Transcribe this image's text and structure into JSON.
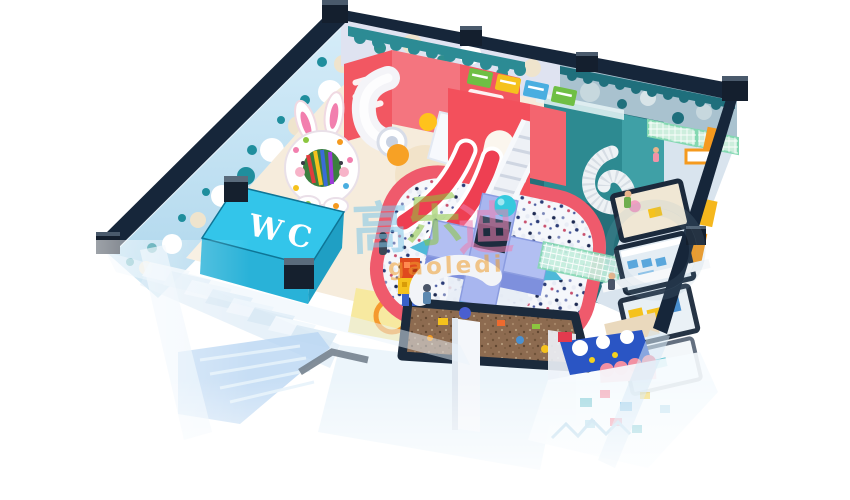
{
  "scene": {
    "description": "isometric 3D render of an indoor children playground",
    "background_color": "#ffffff",
    "wc_sign": {
      "label": "WC",
      "box_color": "#2fc0e4",
      "text_color": "#ffffff"
    },
    "watermark": {
      "chars": [
        {
          "text": "高",
          "color": "#7fc6e8"
        },
        {
          "text": "乐",
          "color": "#8cc63f"
        },
        {
          "text": "迪",
          "color": "#ef7fb0"
        }
      ],
      "latin": "gaoledi",
      "latin_color": "#f09e2e"
    },
    "palette": {
      "wall_frame_navy": "#16263a",
      "left_wall_blue": "#cfe9f7",
      "back_wall_lavender": "#dfe3f1",
      "teal_wall": "#2e8b92",
      "pink_structure": "#f4616d",
      "red_slide": "#ee4157",
      "ball_pit": "#f5f7fb",
      "platform_blue": "#aebdf2",
      "sand_brown": "#8d6b50",
      "glass_frame": "#1b2a3c",
      "orange_accent": "#f59a1e",
      "mesh_green": "#bfe9d6",
      "cyan_accent": "#36c9de",
      "fade_foreground": "#eaf4fb"
    },
    "elements": [
      "polka-dot-walls",
      "toddler-soft-play",
      "bunny-donut-decor",
      "tube-slide",
      "double-wave-slide",
      "white-staircase",
      "ring-ball-pit",
      "center-platform",
      "mesh-bridge",
      "spiral-slide",
      "climbing-nets",
      "party-rooms",
      "sand-pit",
      "wc-room",
      "entrance-stairs",
      "blue-foam-slide",
      "snow-theme-area"
    ]
  }
}
